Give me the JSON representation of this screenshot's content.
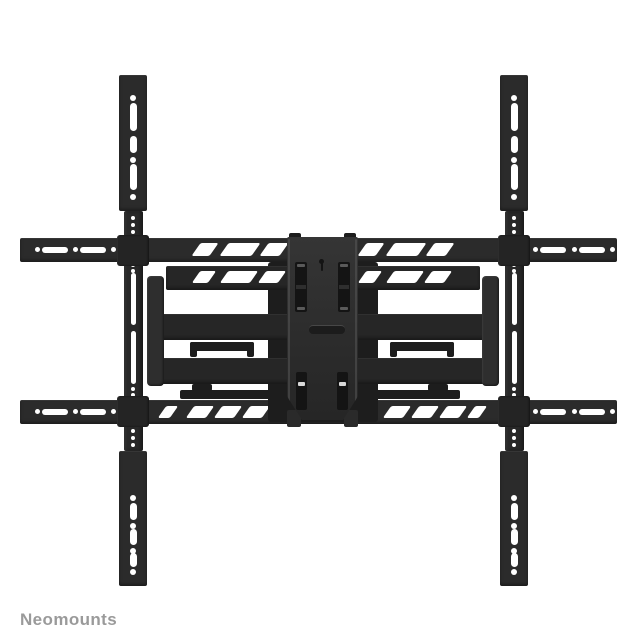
{
  "image": {
    "kind": "product-photo",
    "subject": "Black full-motion TV wall mount with cross rails, folded flat, front view",
    "background": "#ffffff"
  },
  "brand": {
    "label": "Neomounts"
  },
  "colors": {
    "background": "#ffffff",
    "metal": "#2b2b2b",
    "metal_neck": "#282828",
    "metal_arm": "#262626",
    "metal_deep": "#1d1d1d",
    "metal_clamp": "#242424",
    "metal_elbow": "#2e2e2e",
    "cutout": "#141414",
    "brand_text": "#9a9a9a"
  }
}
